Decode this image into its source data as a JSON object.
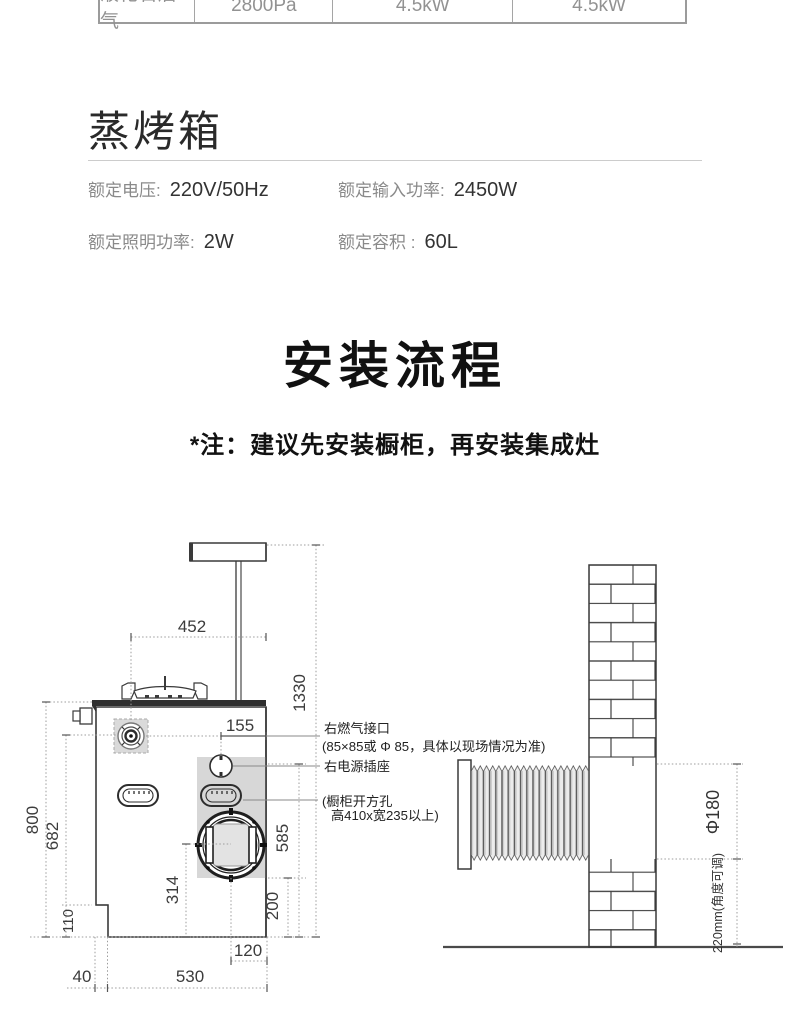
{
  "gas_table": {
    "columns": [
      "液化石油气",
      "2800Pa",
      "4.5kW",
      "4.5kW"
    ]
  },
  "steam_oven": {
    "title": "蒸烤箱",
    "specs": [
      {
        "label": "额定电压:",
        "value": "220V/50Hz"
      },
      {
        "label": "额定输入功率:",
        "value": "2450W"
      },
      {
        "label": "额定照明功率:",
        "value": "2W"
      },
      {
        "label": "额定容积 :",
        "value": "60L"
      }
    ]
  },
  "install": {
    "title": "安装流程",
    "note": "*注：建议先安装橱柜，再安装集成灶"
  },
  "diagram": {
    "dims": {
      "top_width": "452",
      "total_height": "1330",
      "gas_offset": "155",
      "body_height": "800",
      "gas_height": "682",
      "base_height": "110",
      "duct_center_height": "314",
      "cutout_height": "585",
      "cutout_bottom": "200",
      "duct_offset": "120",
      "body_width": "530",
      "notch_width": "40",
      "hole_diameter": "Φ180",
      "wall_duct_height": "220mm(角度可调)"
    },
    "labels": {
      "gas_title": "右燃气接口",
      "gas_detail": "(85×85或 Φ 85，具体以现场情况为准)",
      "socket": "右电源插座",
      "cutout_line1": "(橱柜开方孔",
      "cutout_line2": "高410x宽235以上)"
    }
  }
}
